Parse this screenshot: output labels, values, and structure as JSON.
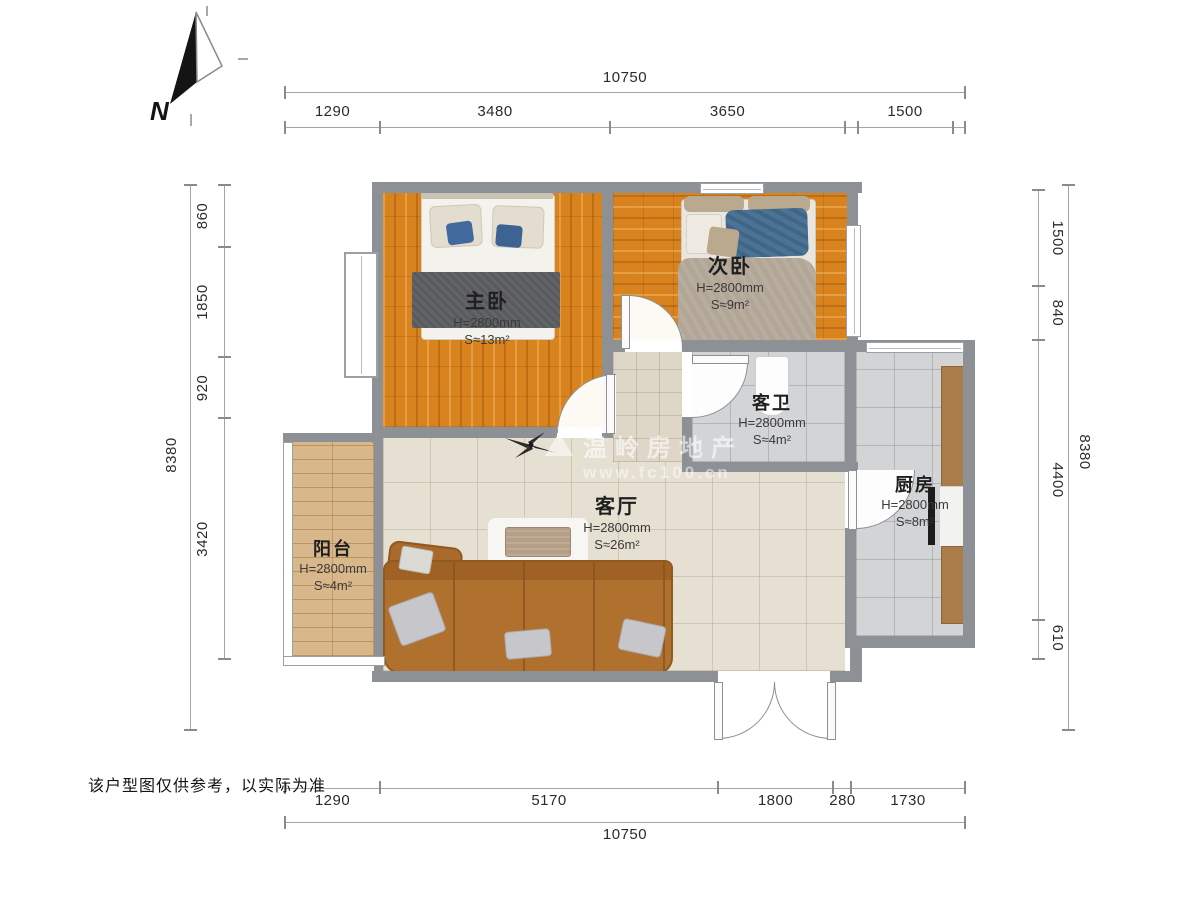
{
  "compass": {
    "label": "N"
  },
  "watermark": {
    "title": "温岭房地产",
    "url": "www.fc100.cn"
  },
  "disclaimer": "该户型图仅供参考，以实际为准",
  "rooms": {
    "master": {
      "name": "主卧",
      "height": "H=2800mm",
      "area": "S≈13m²"
    },
    "second": {
      "name": "次卧",
      "height": "H=2800mm",
      "area": "S≈9m²"
    },
    "bath": {
      "name": "客卫",
      "height": "H=2800mm",
      "area": "S≈4m²"
    },
    "kitchen": {
      "name": "厨房",
      "height": "H=2800mm",
      "area": "S≈8m²"
    },
    "living": {
      "name": "客厅",
      "height": "H=2800mm",
      "area": "S≈26m²"
    },
    "balcony": {
      "name": "阳台",
      "height": "H=2800mm",
      "area": "S≈4m²"
    }
  },
  "dimensions": {
    "top": {
      "total": "10750",
      "segments": [
        "1290",
        "3480",
        "3650",
        "1500"
      ]
    },
    "bottom": {
      "total": "10750",
      "segments": [
        "1290",
        "5170",
        "1800",
        "280",
        "1730"
      ]
    },
    "left": {
      "total": "8380",
      "segments": [
        "860",
        "1850",
        "920",
        "3420"
      ]
    },
    "right": {
      "total": "8380",
      "segments": [
        "1500",
        "840",
        "4400",
        "610"
      ]
    }
  },
  "colors": {
    "wall": "#8d9095",
    "bedroom_wood": "#d9831f",
    "balcony_wood": "#d8b88a",
    "living_tile": "#e6e0d3",
    "wet_tile": "#d3d4d6",
    "sofa": "#b0712e",
    "blanket_gray": "#595a5e",
    "accent_blue": "#41699b"
  }
}
